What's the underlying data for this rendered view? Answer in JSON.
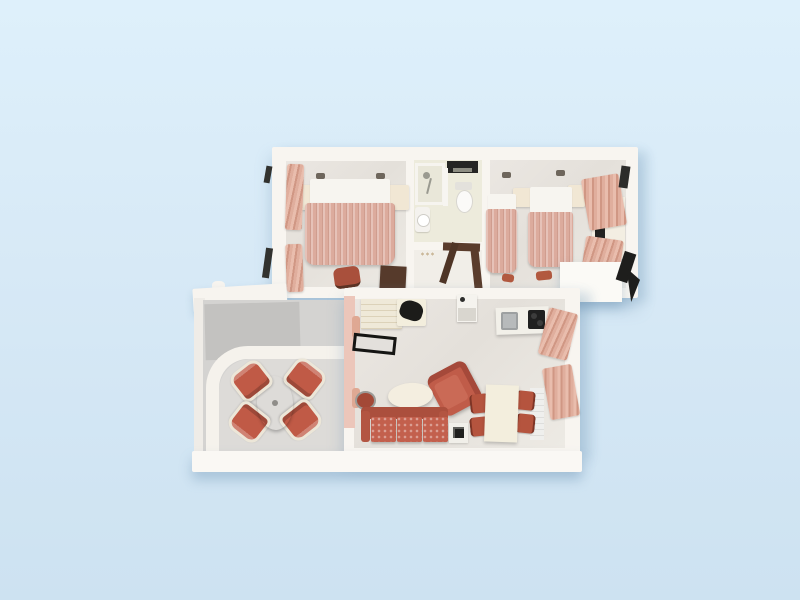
{
  "scene": {
    "description": "3D rendered top-down floor plan of a two-level holiday apartment on a plain light blue background",
    "view": "top-down 3D render",
    "has_text": false,
    "background_color": "#d7e9f6"
  },
  "palette": {
    "background_top": "#def0fb",
    "background_bottom": "#cde2f1",
    "wall_white": "#f8f5f0",
    "floor_marble": "#e8e4df",
    "bathroom_floor": "#edebdc",
    "terrace_concrete": "#c3c2c0",
    "terrace_paving": "#dddbd8",
    "salmon_fabric": "#dfae9d",
    "terracotta_upholstery": "#c05a46",
    "cream_furniture": "#f2ebd9",
    "dark_wood": "#57392b",
    "black_accent": "#232321"
  },
  "upper_floor": {
    "name": "bedroom level",
    "rooms": [
      {
        "name": "master bedroom",
        "furniture": [
          "double bed with salmon striped duvet",
          "arched headboard",
          "left nightstand",
          "right nightstand",
          "two wall sconces",
          "two salmon window curtains",
          "chair",
          "dark wood desk"
        ]
      },
      {
        "name": "bathroom",
        "furniture": [
          "shower with hand-held head",
          "glass screen",
          "toilet with tank",
          "wash basin",
          "black wall shelf"
        ]
      },
      {
        "name": "hallway",
        "furniture": [
          "dark wood console desk"
        ]
      },
      {
        "name": "twin bedroom",
        "furniture": [
          "twin bed left",
          "twin bed right",
          "two cream nightstands",
          "TV cabinet with dark screen",
          "two salmon curtains",
          "luggage bench",
          "two small red stools"
        ]
      }
    ],
    "exterior": [
      "dark shuttered windows on left wall",
      "dark window on right wall",
      "white balcony slab",
      "dark awning at lower right"
    ]
  },
  "lower_floor": {
    "name": "living level",
    "rooms": [
      {
        "name": "terrace",
        "furniture": [
          "oval marble table",
          "four terracotta armchairs",
          "curved white parapet wall",
          "white roof overhang"
        ]
      },
      {
        "name": "living room",
        "furniture": [
          "staircase",
          "desk with black chair",
          "black-framed luggage rack",
          "mini-bar unit",
          "kitchenette counter with steel sink and black stove",
          "three-seat terracotta sofa",
          "terracotta armchair",
          "oval cream coffee table",
          "round pouf",
          "side table with black device",
          "cream dining table",
          "four red dining chairs",
          "white radiator",
          "salmon curtains on right wall"
        ]
      }
    ]
  },
  "counts": {
    "bedrooms": 2,
    "beds_double": 1,
    "beds_twin": 2,
    "bathrooms": 1,
    "terrace_chairs": 4,
    "dining_chairs": 4,
    "sofa_seats": 3
  }
}
